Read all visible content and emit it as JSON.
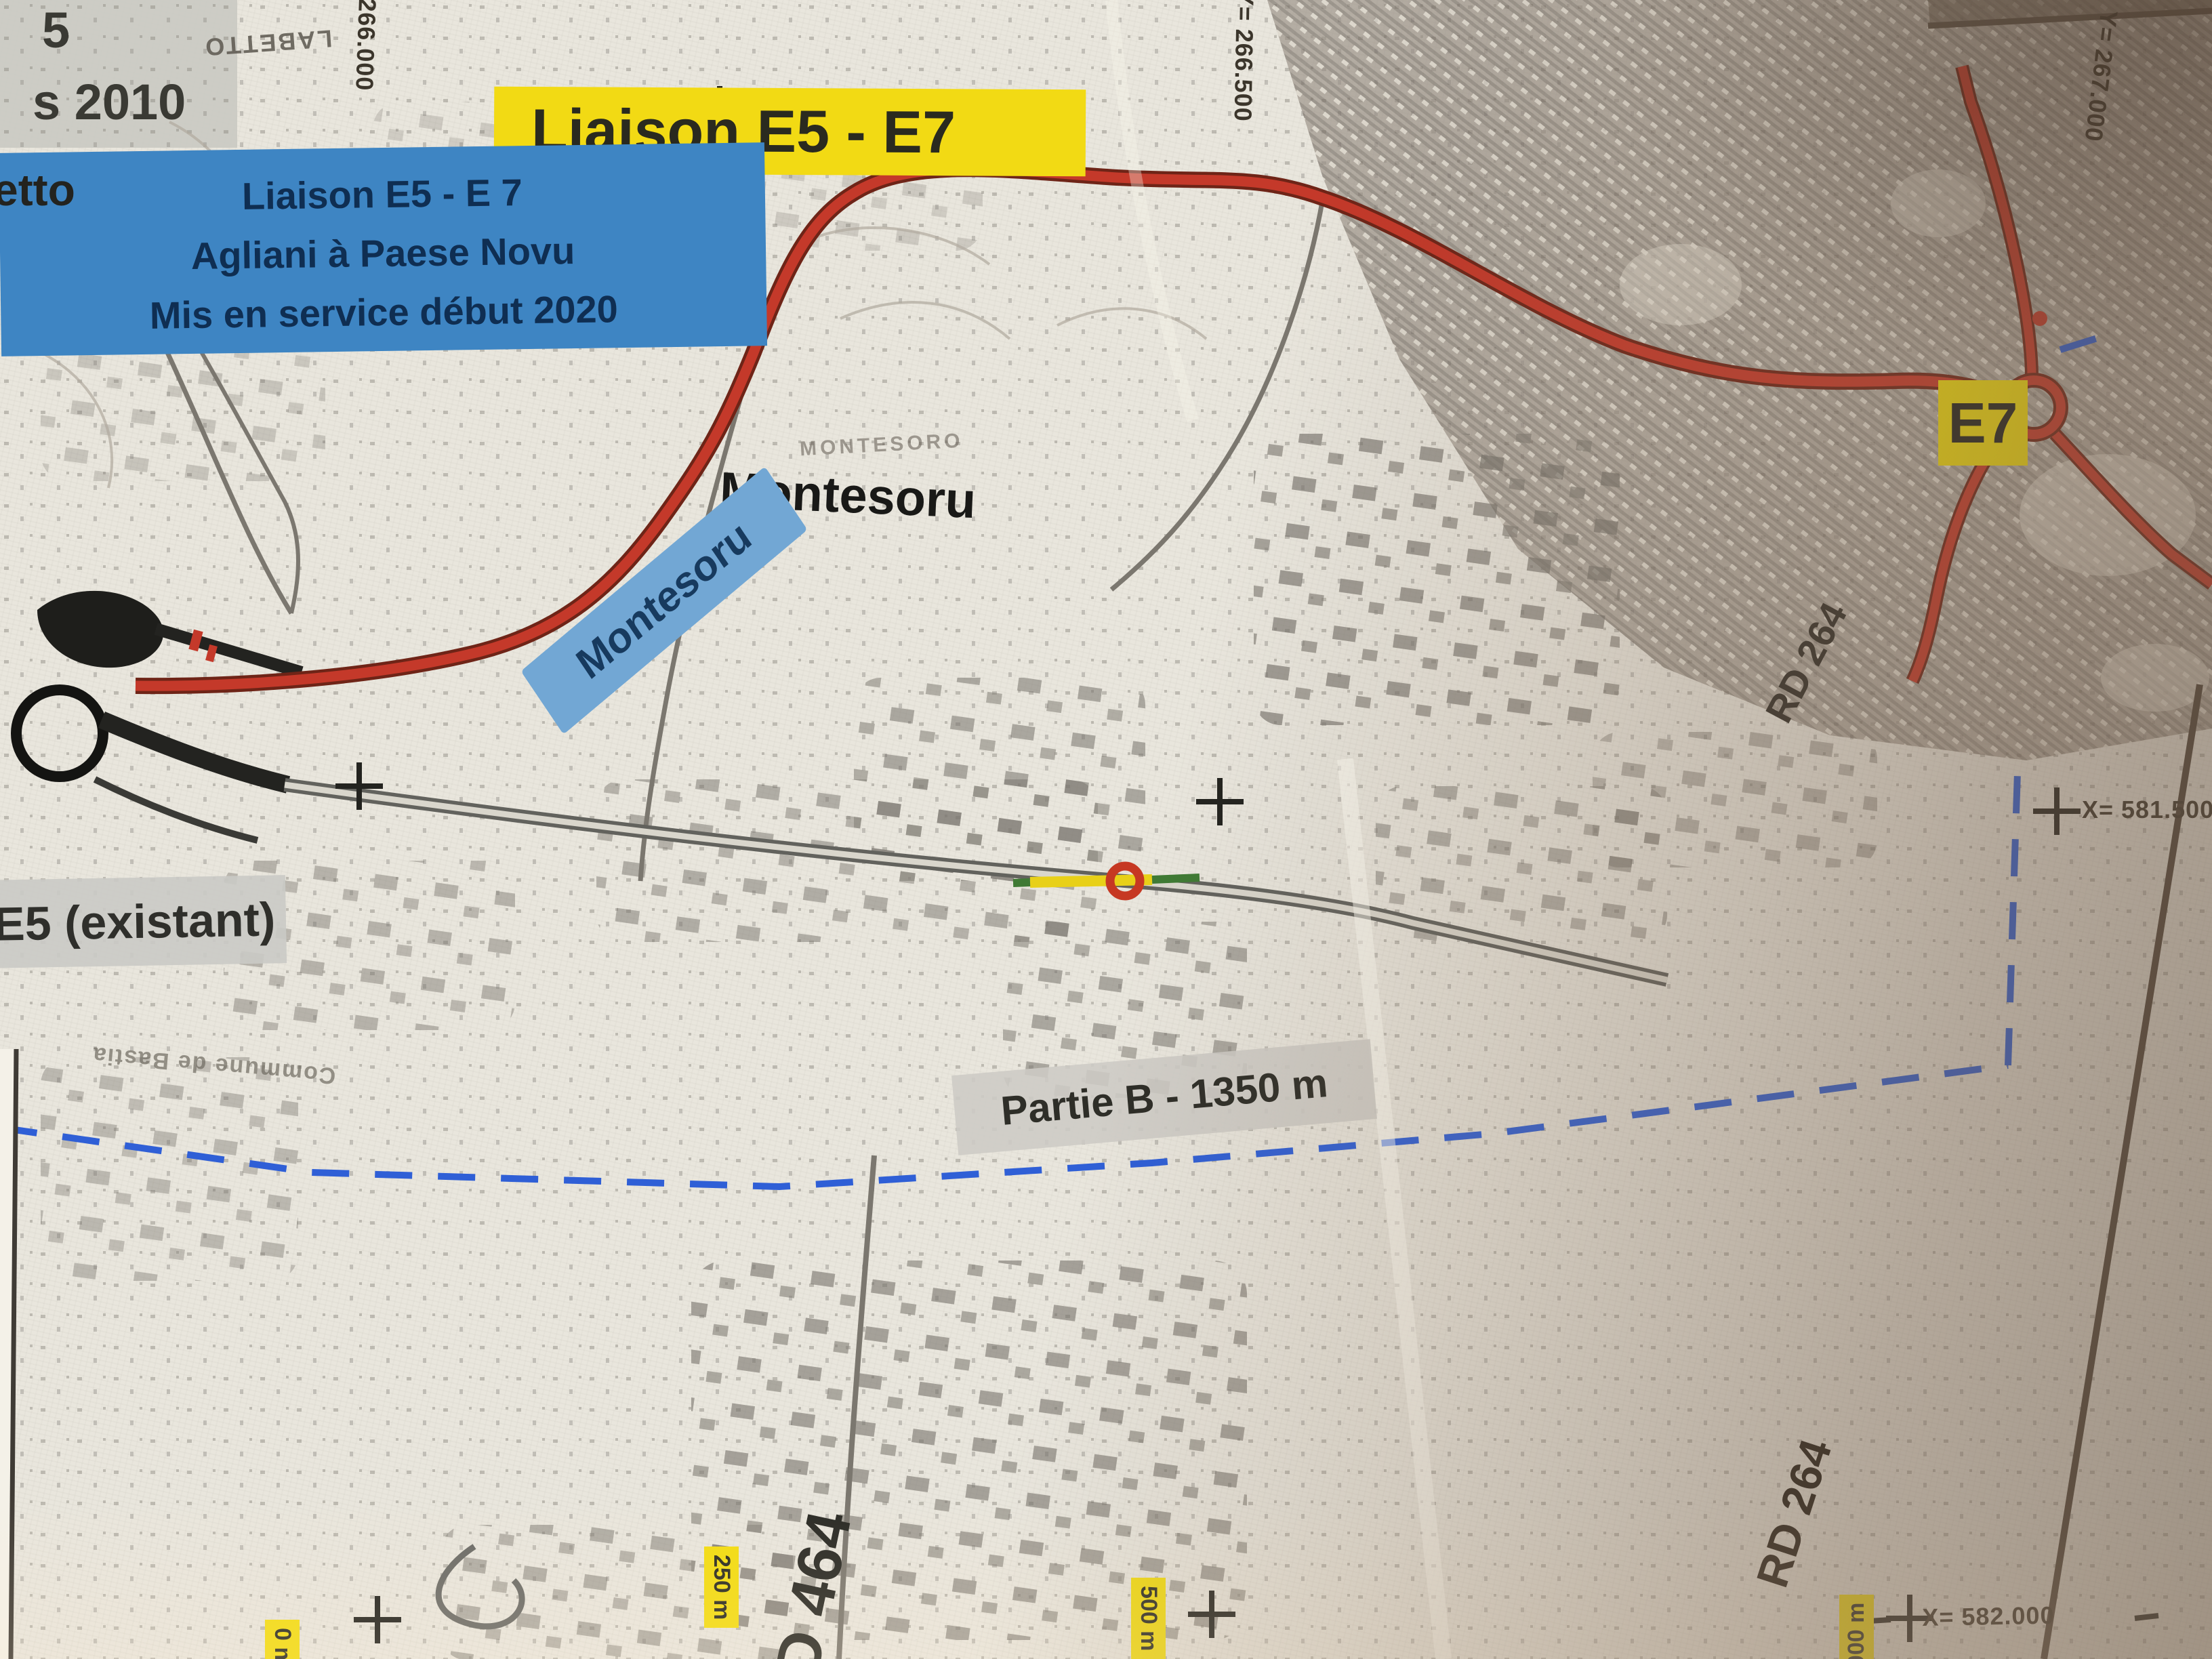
{
  "map": {
    "banner": "Liaison E5 - E7",
    "place_label": "Montesoru",
    "faint_place": "MONTESORO",
    "road_label_montesoru": "Montesoru",
    "e7_badge": "E7",
    "rd264_upper": "RD 264",
    "rd264_lower": "RD 264",
    "d464": "D 464",
    "e5_existing": "E5 (existant)",
    "partial_label": {
      "line1": "5",
      "line2": "s 2010"
    },
    "partie_b": "Partie B - 1350 m",
    "info_box": {
      "line1": "Liaison E5  - E 7",
      "line2": "Agliani à Paese Novu",
      "line3": "Mis en service début 2020"
    },
    "labetto": "LABETTO",
    "etto_partial": "etto",
    "commune": "Commune de Bastia",
    "scale_marks": [
      "0 m",
      "250 m",
      "500 m",
      "1000 m"
    ],
    "grid": {
      "y1": "Y= 266.000",
      "y2": "Y= 266.500",
      "y3": "Y= 267.000",
      "x1": "X= 581.500",
      "x2": "X= 582.000"
    },
    "colors": {
      "highlight_yellow": "#f2da14",
      "road_red": "#c4392a",
      "info_blue": "#3e85c3",
      "road_label_blue": "#72a7d4",
      "dash_blue": "#2f5fd6",
      "label_gray": "#cbcac5"
    }
  }
}
